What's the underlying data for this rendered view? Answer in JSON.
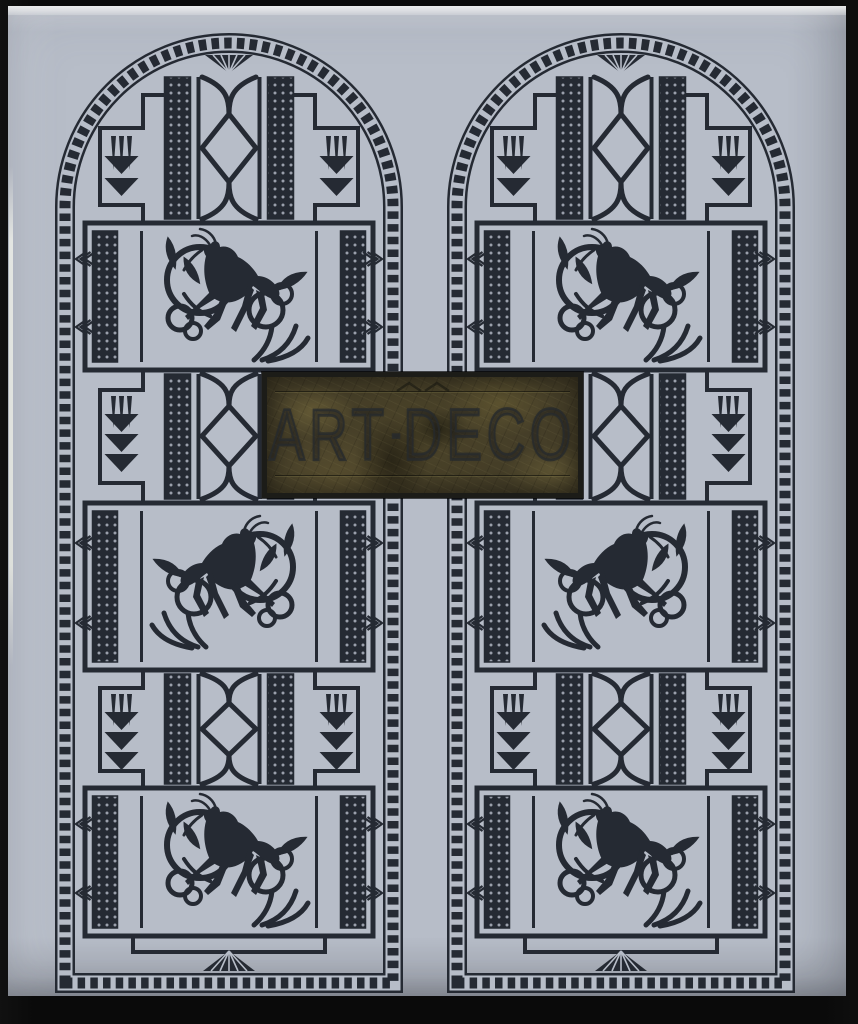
{
  "photo": {
    "background_color": "#0a0a0a"
  },
  "cover": {
    "base_color": "#b7bdc8",
    "ink_color": "#252a33",
    "title": {
      "part1": "ART",
      "separator": "-",
      "part2": "DECO"
    },
    "plaque": {
      "gold_base": "#453e28",
      "gold_light": "#8a7b46",
      "frame_color": "#1c1c18"
    },
    "motifs": {
      "left_panel": "arched-window-ornament",
      "right_panel": "arched-window-ornament",
      "animal": "leaping-gazelle",
      "repeats": "dotted-columns, diamond-lattice, chevron-darts, pleated-fans"
    }
  }
}
